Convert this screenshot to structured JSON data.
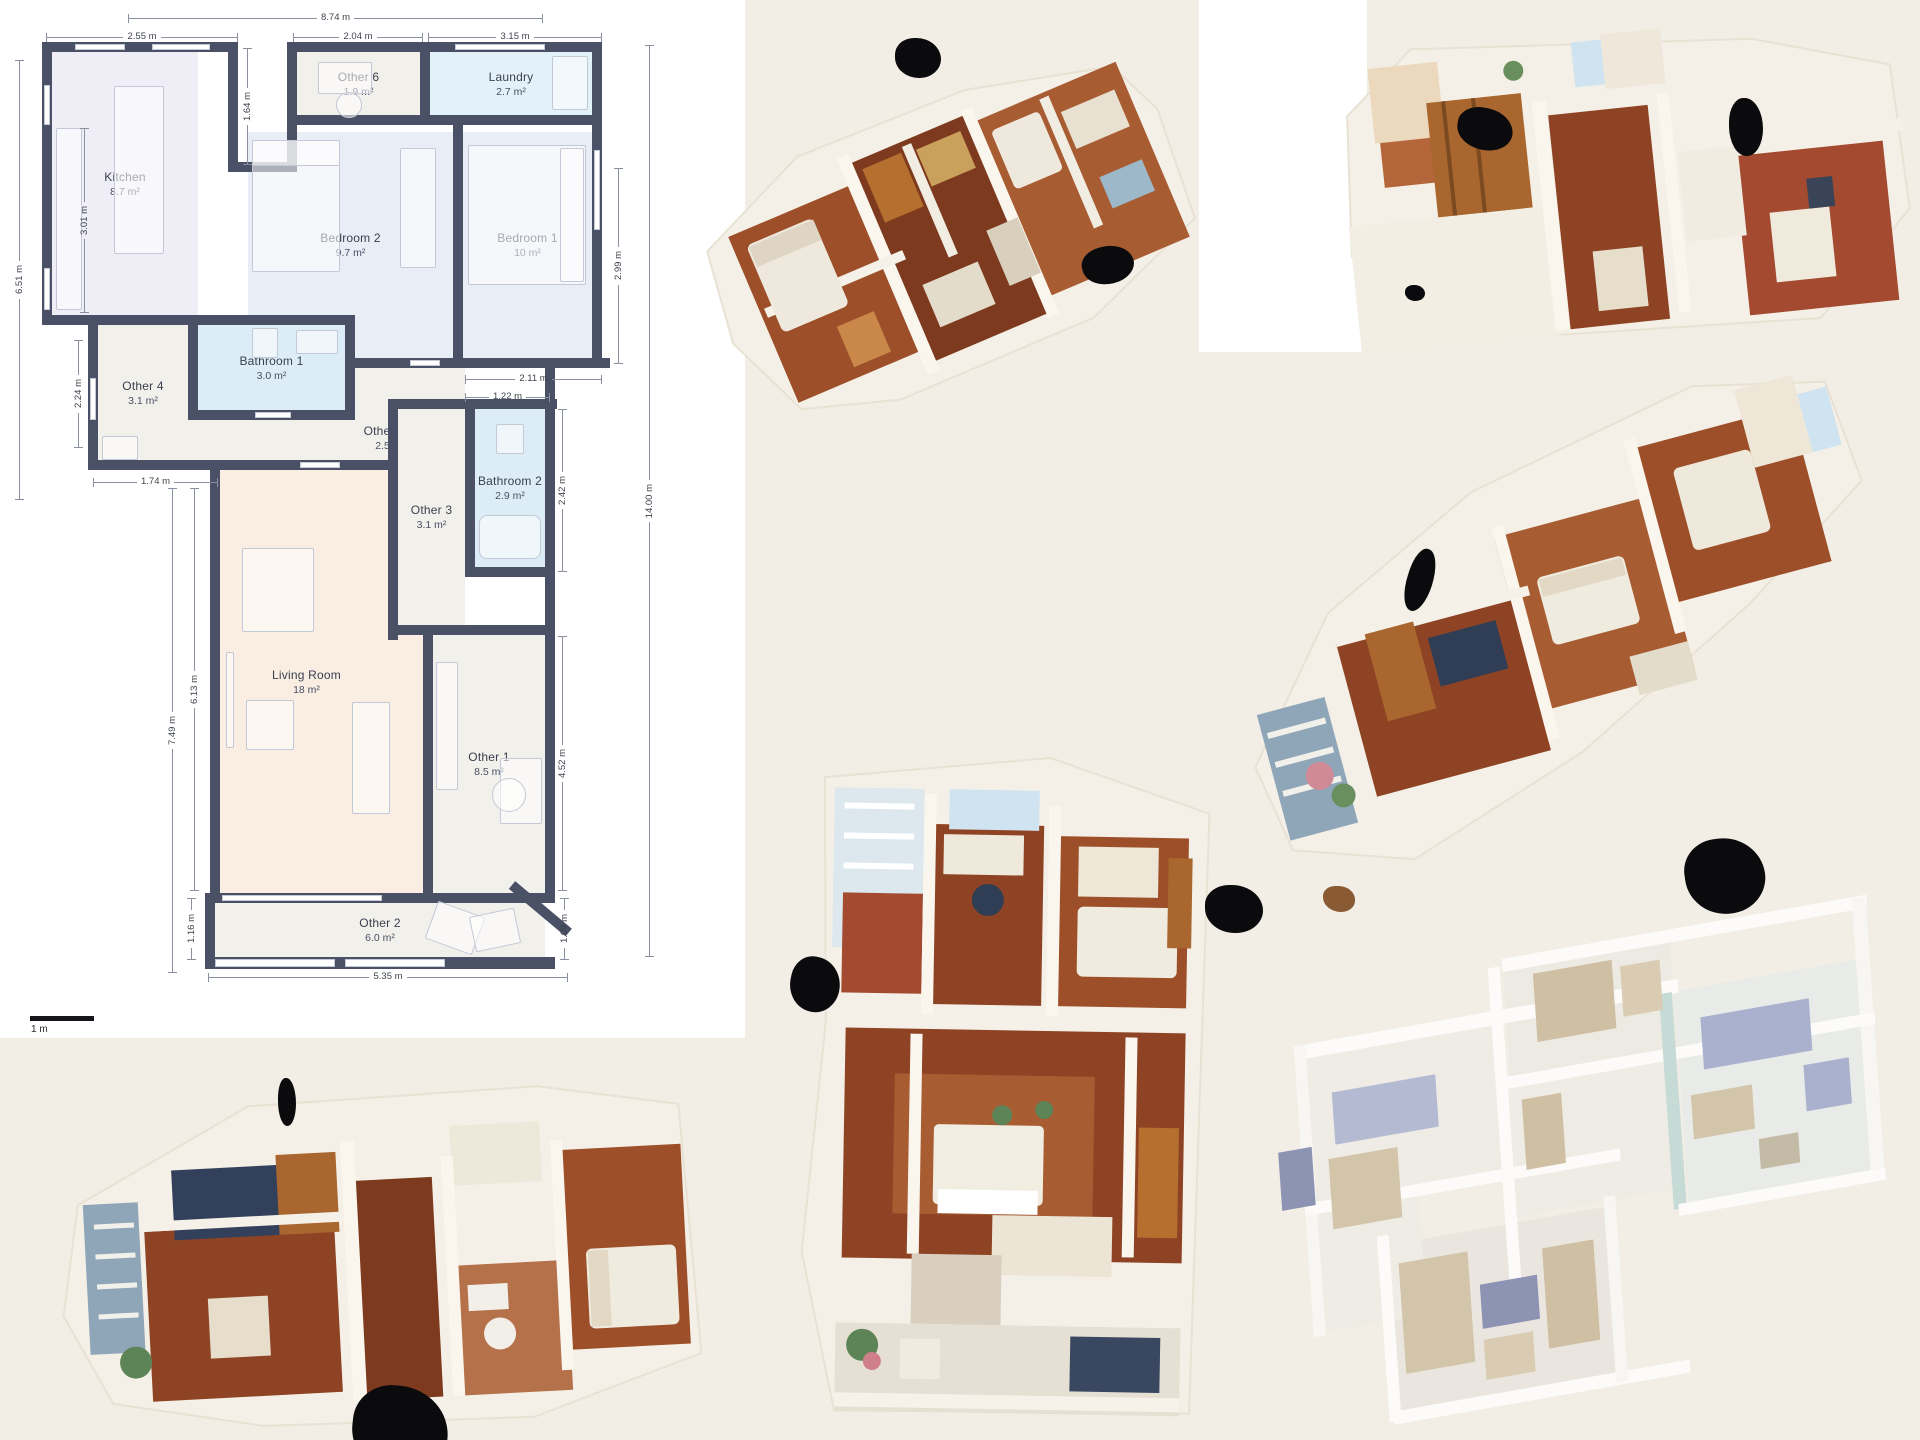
{
  "floor_plan": {
    "scale_label": "1 m",
    "rooms": {
      "kitchen": {
        "name": "Kitchen",
        "area": "8.7 m²"
      },
      "other6": {
        "name": "Other 6",
        "area": "1.9 m²"
      },
      "laundry": {
        "name": "Laundry",
        "area": "2.7 m²"
      },
      "bedroom2": {
        "name": "Bedroom 2",
        "area": "9.7 m²"
      },
      "bedroom1": {
        "name": "Bedroom 1",
        "area": "10 m²"
      },
      "bathroom1": {
        "name": "Bathroom 1",
        "area": "3.0 m²"
      },
      "other4": {
        "name": "Other 4",
        "area": "3.1 m²"
      },
      "other5": {
        "name": "Other 5",
        "area": "2.5 m²"
      },
      "bathroom2": {
        "name": "Bathroom 2",
        "area": "2.9 m²"
      },
      "other3": {
        "name": "Other 3",
        "area": "3.1 m²"
      },
      "living": {
        "name": "Living Room",
        "area": "18 m²"
      },
      "other1": {
        "name": "Other 1",
        "area": "8.5 m²"
      },
      "other2": {
        "name": "Other 2",
        "area": "6.0 m²"
      }
    },
    "dims": {
      "top_total": "8.74 m",
      "kitchen_width": "2.55 m",
      "other6_width": "2.04 m",
      "laundry_width": "3.15 m",
      "left_height": "6.51 m",
      "kitchen_height": "3.01 m",
      "notch_height": "1.64 m",
      "bedroom1_height": "2.99 m",
      "total_height": "14.00 m",
      "hall_width": "2.11 m",
      "bathroom2_width": "1.22 m",
      "other4_height": "2.24 m",
      "entry_width": "1.74 m",
      "living_outer_height": "7.49 m",
      "living_height": "6.13 m",
      "bathroom2_height": "2.42 m",
      "other1_height": "4.52 m",
      "other2_height": "1.16 m",
      "other2_width": "5.35 m",
      "other2_right_height": "1.09 m"
    },
    "colors": {
      "wall": "#4a5065",
      "kitchen_fill": "#efedf6",
      "bedroom_fill": "#e9edf6",
      "bath_fill": "#dcedf7",
      "laundry_fill": "#e3f1f9",
      "other_fill": "#f1f0ea",
      "living_fill": "#faeee3"
    }
  },
  "views": {
    "scan_top_center": "textured 3D dollhouse scan",
    "scan_top_right": "textured 3D dollhouse scan",
    "scan_mid_right": "textured 3D dollhouse scan",
    "scan_bottom_left": "textured 3D dollhouse scan",
    "scan_bottom_center": "textured 3D dollhouse scan",
    "render_bottom_right": "untextured 3D model render"
  },
  "palette": {
    "background": "#f2eee5",
    "panel": "#ffffff",
    "scan_wall": "#f5f0e7",
    "floor_wood": "#9c4f28",
    "render_tan": "#d3c5a9",
    "render_lavender": "#aab1ce"
  }
}
